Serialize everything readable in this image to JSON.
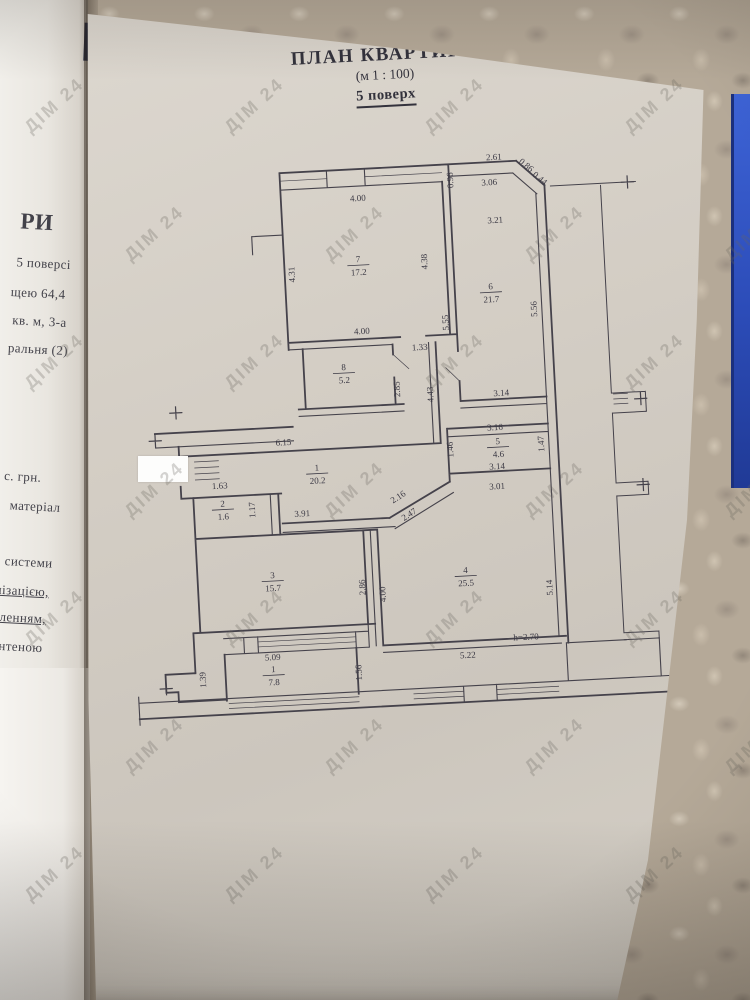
{
  "photo": {
    "watermark_text": "ДІМ 24"
  },
  "plan_sheet": {
    "title": "ПЛАН КВАРТИРИ",
    "scale": "(м 1 : 100)",
    "floor": "5 поверх"
  },
  "left_page": {
    "visible_text_lines": [
      {
        "t": "РИ",
        "x": 6,
        "y": 210,
        "fs": 23,
        "b": true,
        "u": false
      },
      {
        "t": "5  поверсі",
        "x": 4,
        "y": 256,
        "fs": 13,
        "b": false,
        "u": false
      },
      {
        "t": "щею 64,4",
        "x": 0,
        "y": 286,
        "fs": 13,
        "b": false,
        "u": false
      },
      {
        "t": "кв. м, 3-а",
        "x": 3,
        "y": 314,
        "fs": 13,
        "b": false,
        "u": false
      },
      {
        "t": "ральня (2)",
        "x": 0,
        "y": 342,
        "fs": 13,
        "b": false,
        "u": false
      },
      {
        "t": "с. грн.",
        "x": 3,
        "y": 470,
        "fs": 13,
        "b": false,
        "u": false
      },
      {
        "t": "матеріал",
        "x": 10,
        "y": 499,
        "fs": 13,
        "b": false,
        "u": false
      },
      {
        "t": "системи",
        "x": 8,
        "y": 555,
        "fs": 13,
        "b": false,
        "u": false
      },
      {
        "t": "лізацією,",
        "x": 0,
        "y": 584,
        "fs": 13,
        "b": false,
        "u": true
      },
      {
        "t": "тленням,",
        "x": 0,
        "y": 611,
        "fs": 13,
        "b": false,
        "u": true
      },
      {
        "t": "антеною",
        "x": 0,
        "y": 640,
        "fs": 13,
        "b": false,
        "u": false
      }
    ]
  },
  "floor_plan": {
    "rooms": [
      {
        "n": "7",
        "a": "17.2",
        "x": 272,
        "y": 121
      },
      {
        "n": "8",
        "a": "5.2",
        "x": 252,
        "y": 228
      },
      {
        "n": "6",
        "a": "21.7",
        "x": 403,
        "y": 155
      },
      {
        "n": "5",
        "a": "4.6",
        "x": 402,
        "y": 310
      },
      {
        "n": "1",
        "a": "20.2",
        "x": 220,
        "y": 327
      },
      {
        "n": "2",
        "a": "1.6",
        "x": 124,
        "y": 358
      },
      {
        "n": "3",
        "a": "15.7",
        "x": 170,
        "y": 432
      },
      {
        "n": "4",
        "a": "25.5",
        "x": 363,
        "y": 437
      },
      {
        "n": "1",
        "a": "7.8",
        "x": 166,
        "y": 526
      }
    ],
    "dimensions": [
      {
        "t": "4.00",
        "x": 275,
        "y": 60,
        "r": 0
      },
      {
        "t": "0.96",
        "x": 371,
        "y": 44,
        "r": -90
      },
      {
        "t": "2.61",
        "x": 413,
        "y": 26,
        "r": 0
      },
      {
        "t": "0.86",
        "x": 443,
        "y": 35,
        "r": 42
      },
      {
        "t": "0.44",
        "x": 456,
        "y": 49,
        "r": 42
      },
      {
        "t": "3.06",
        "x": 407,
        "y": 51,
        "r": 0
      },
      {
        "t": "3.21",
        "x": 411,
        "y": 89,
        "r": 0
      },
      {
        "t": "4.31",
        "x": 208,
        "y": 130,
        "r": -90
      },
      {
        "t": "4.38",
        "x": 341,
        "y": 124,
        "r": -90
      },
      {
        "t": "5.55",
        "x": 359,
        "y": 186,
        "r": -90
      },
      {
        "t": "5.56",
        "x": 448,
        "y": 177,
        "r": -90
      },
      {
        "t": "4.00",
        "x": 272,
        "y": 193,
        "r": 0
      },
      {
        "t": "1.33",
        "x": 329,
        "y": 212,
        "r": 0
      },
      {
        "t": "2.85",
        "x": 307,
        "y": 250,
        "r": -90
      },
      {
        "t": "4.43",
        "x": 340,
        "y": 257,
        "r": -90
      },
      {
        "t": "3.14",
        "x": 408,
        "y": 262,
        "r": 0
      },
      {
        "t": "6.15",
        "x": 188,
        "y": 300,
        "r": 0
      },
      {
        "t": "3.16",
        "x": 400,
        "y": 296,
        "r": 0
      },
      {
        "t": "1.46",
        "x": 357,
        "y": 313,
        "r": -90
      },
      {
        "t": "1.47",
        "x": 448,
        "y": 312,
        "r": -90
      },
      {
        "t": "1.41",
        "x": 70,
        "y": 321,
        "r": -90
      },
      {
        "t": "3.14",
        "x": 400,
        "y": 335,
        "r": 0
      },
      {
        "t": "1.63",
        "x": 122,
        "y": 340,
        "r": 0
      },
      {
        "t": "3.01",
        "x": 399,
        "y": 355,
        "r": 0
      },
      {
        "t": "2.16",
        "x": 301,
        "y": 360,
        "r": -30
      },
      {
        "t": "1.17",
        "x": 156,
        "y": 363,
        "r": -90
      },
      {
        "t": "3.91",
        "x": 203,
        "y": 372,
        "r": 0
      },
      {
        "t": "2.47",
        "x": 311,
        "y": 378,
        "r": -30
      },
      {
        "t": "2.86",
        "x": 262,
        "y": 446,
        "r": -90
      },
      {
        "t": "4.00",
        "x": 282,
        "y": 454,
        "r": -90
      },
      {
        "t": "5.14",
        "x": 449,
        "y": 456,
        "r": -90
      },
      {
        "t": "h=2.70",
        "x": 420,
        "y": 507,
        "r": 0
      },
      {
        "t": "5.09",
        "x": 166,
        "y": 514,
        "r": 0
      },
      {
        "t": "5.22",
        "x": 361,
        "y": 522,
        "r": 0
      },
      {
        "t": "1.39",
        "x": 98,
        "y": 530,
        "r": -90
      },
      {
        "t": "1.56",
        "x": 254,
        "y": 531,
        "r": -90
      }
    ]
  }
}
